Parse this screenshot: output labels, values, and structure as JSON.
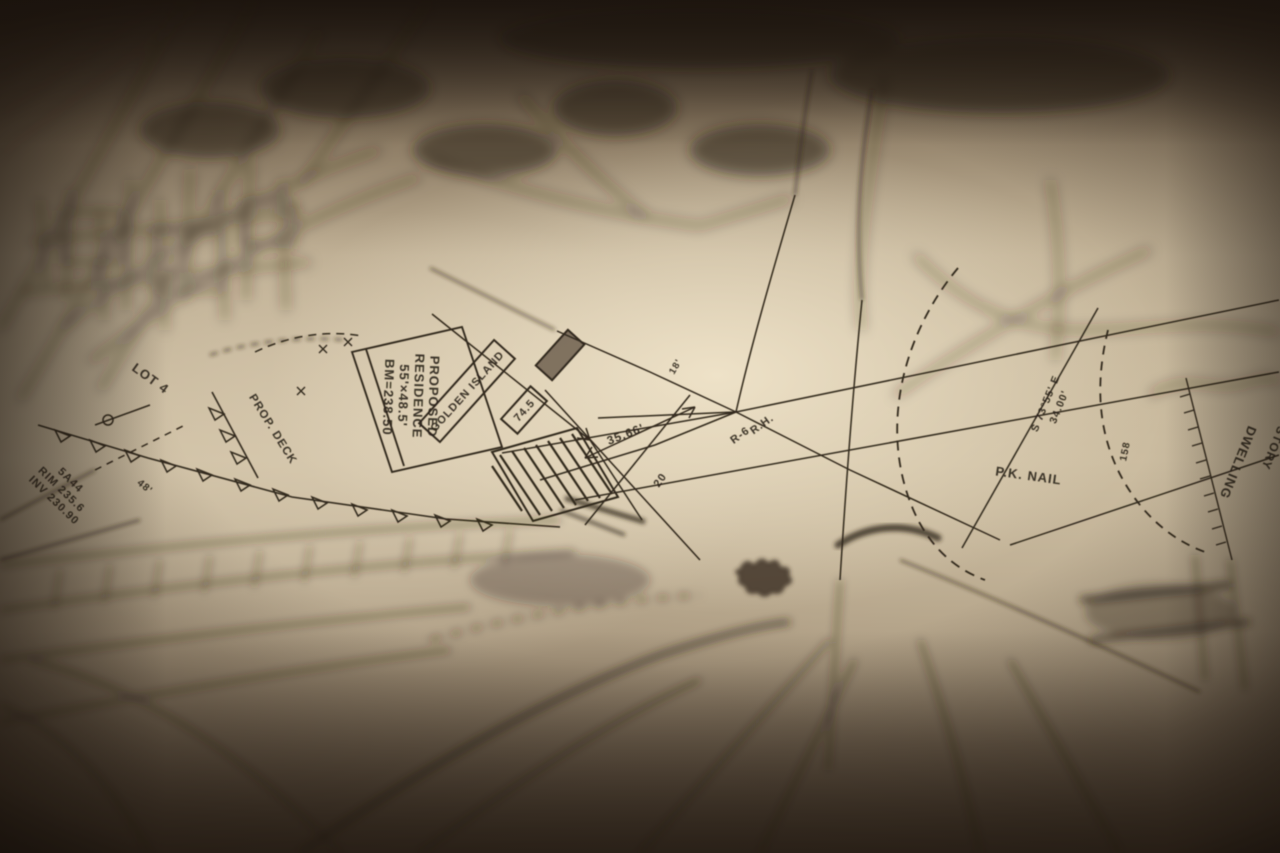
{
  "scene": {
    "colors": {
      "paper_highlight": "#f0e4ca",
      "paper_mid": "#cfc0a4",
      "paper_shadow": "#84735c",
      "corner_dark": "#16100a",
      "ink": "#33291f"
    }
  },
  "labels": {
    "proposed_block": [
      "PROPOSED",
      "RESIDENCE",
      "55'×48.5'",
      "BM=238.50"
    ],
    "island_box": "GOLDEN ISLAND",
    "small_box": "74.5",
    "lot": "LOT 4",
    "deck": "PROP. DECK",
    "manhole_block": [
      "5A44",
      "RIM 235.6",
      "INV 230.90"
    ],
    "dim_48": "48'",
    "dim_3566": "35.66'",
    "dim_20": "20",
    "dim_18": "18'",
    "rh": "R.H.",
    "r6": "R-6",
    "pk_nail": "P.K. NAIL",
    "bearing": "S 73°55' E",
    "bearing_len": "34.00'",
    "contour": "158",
    "dwelling": "DWELLING",
    "story": "2 STORY"
  }
}
